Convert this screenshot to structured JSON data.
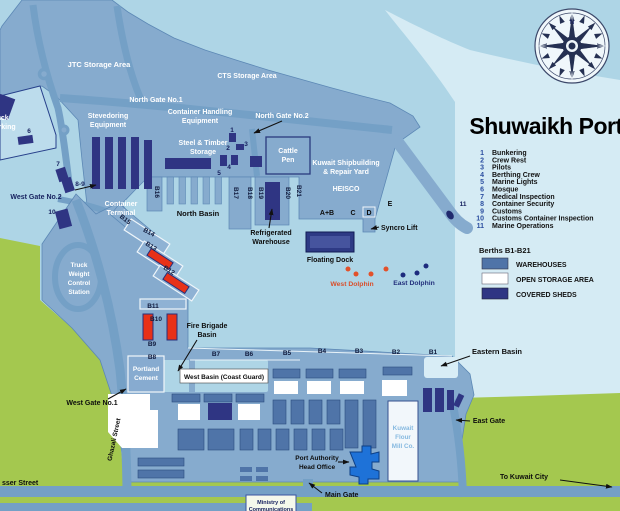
{
  "title": "Shuwaikh Port",
  "legend": {
    "items": [
      {
        "num": "1",
        "label": "Bunkering"
      },
      {
        "num": "2",
        "label": "Crew Rest"
      },
      {
        "num": "3",
        "label": "Pilots"
      },
      {
        "num": "4",
        "label": "Berthing Crew"
      },
      {
        "num": "5",
        "label": "Marine Lights"
      },
      {
        "num": "6",
        "label": "Mosque"
      },
      {
        "num": "7",
        "label": "Medical Inspection"
      },
      {
        "num": "8",
        "label": "Container Security"
      },
      {
        "num": "9",
        "label": "Customs"
      },
      {
        "num": "10",
        "label": "Customs Container Inspection"
      },
      {
        "num": "11",
        "label": "Marine Operations"
      }
    ],
    "berths_heading": "Berths B1-B21",
    "swatches": [
      {
        "label": "WAREHOUSES",
        "color": "#4f74a8"
      },
      {
        "label": "OPEN STORAGE AREA",
        "color": "#ffffff"
      },
      {
        "label": "COVERED SHEDS",
        "color": "#2f3583"
      }
    ]
  },
  "map": {
    "jtc": "JTC Storage Area",
    "cts": "CTS Storage Area",
    "north_gate_1": "North Gate No.1",
    "north_gate_2": "North Gate No.2",
    "stevedoring": [
      "Stevedoring",
      "Equipment"
    ],
    "container_handling": [
      "Container Handling",
      "Equipment"
    ],
    "steel_timber": [
      "Steel & Timber",
      "Storage"
    ],
    "cattle_pen": [
      "Cattle",
      "Pen"
    ],
    "shipyard": [
      "Kuwait Shipbuilding",
      "& Repair Yard"
    ],
    "heisco": "HEISCO",
    "truck_parking": [
      "Truck",
      "Parking"
    ],
    "west_gate_2": "West Gate No.2",
    "container_terminal": [
      "Container",
      "Terminal"
    ],
    "north_basin": "North Basin",
    "refrigerated": [
      "Refrigerated",
      "Warehouse"
    ],
    "truck_weight": [
      "Truck",
      "Weight",
      "Control",
      "Station"
    ],
    "floating_dock": "Floating Dock",
    "syncro_lift": "Syncro Lift",
    "west_dolphin": "West Dolphin",
    "east_dolphin": "East Dolphin",
    "fire_brigade": [
      "Fire Brigade",
      "Basin"
    ],
    "west_basin": "West Basin (Coast Guard)",
    "eastern_basin": "Eastern Basin",
    "portland": [
      "Portland",
      "Cement"
    ],
    "west_gate_1": "West Gate No.1",
    "east_gate": "East Gate",
    "flour_mill": [
      "Kuwait",
      "Flour",
      "Mill Co."
    ],
    "port_authority": [
      "Port Authority",
      "Head Office"
    ],
    "main_gate": "Main Gate",
    "to_kuwait": "To Kuwait City",
    "ghazali": "Ghazali Street",
    "nasser": "sser Street",
    "ministry": [
      "Ministry of",
      "Communications"
    ],
    "quays": {
      "ab": "A+B",
      "c": "C",
      "d": "D",
      "e": "E"
    },
    "markers": {
      "m1": "1",
      "m2": "2",
      "m3": "3",
      "m4": "4",
      "m5": "5",
      "m6": "6",
      "m7": "7",
      "m8_9": "8-9",
      "m10": "10",
      "m11": "11",
      "n": "N"
    },
    "berths": {
      "b1": "B1",
      "b2": "B2",
      "b3": "B3",
      "b4": "B4",
      "b5": "B5",
      "b6": "B6",
      "b7": "B7",
      "b8": "B8",
      "b9": "B9",
      "b10": "B10",
      "b11": "B11",
      "b12": "B12",
      "b13": "B13",
      "b14": "B14",
      "b15": "B15",
      "b16": "B16",
      "b17": "B17",
      "b18": "B18",
      "b19": "B19",
      "b20": "B20",
      "b21": "B21"
    }
  },
  "colors": {
    "sea": "#aed5e6",
    "sea_light": "#d5ebf4",
    "port_land": "#86abce",
    "green": "#a4c84f",
    "road": "#74a0c6",
    "warehouse": "#4f74a8",
    "covered_shed": "#2f3583",
    "open_storage": "#ffffff",
    "crane_red": "#e83118",
    "dolphin_west": "#e2512b",
    "dolphin_east": "#1d2b7d",
    "pa_building": "#1e72d8"
  }
}
